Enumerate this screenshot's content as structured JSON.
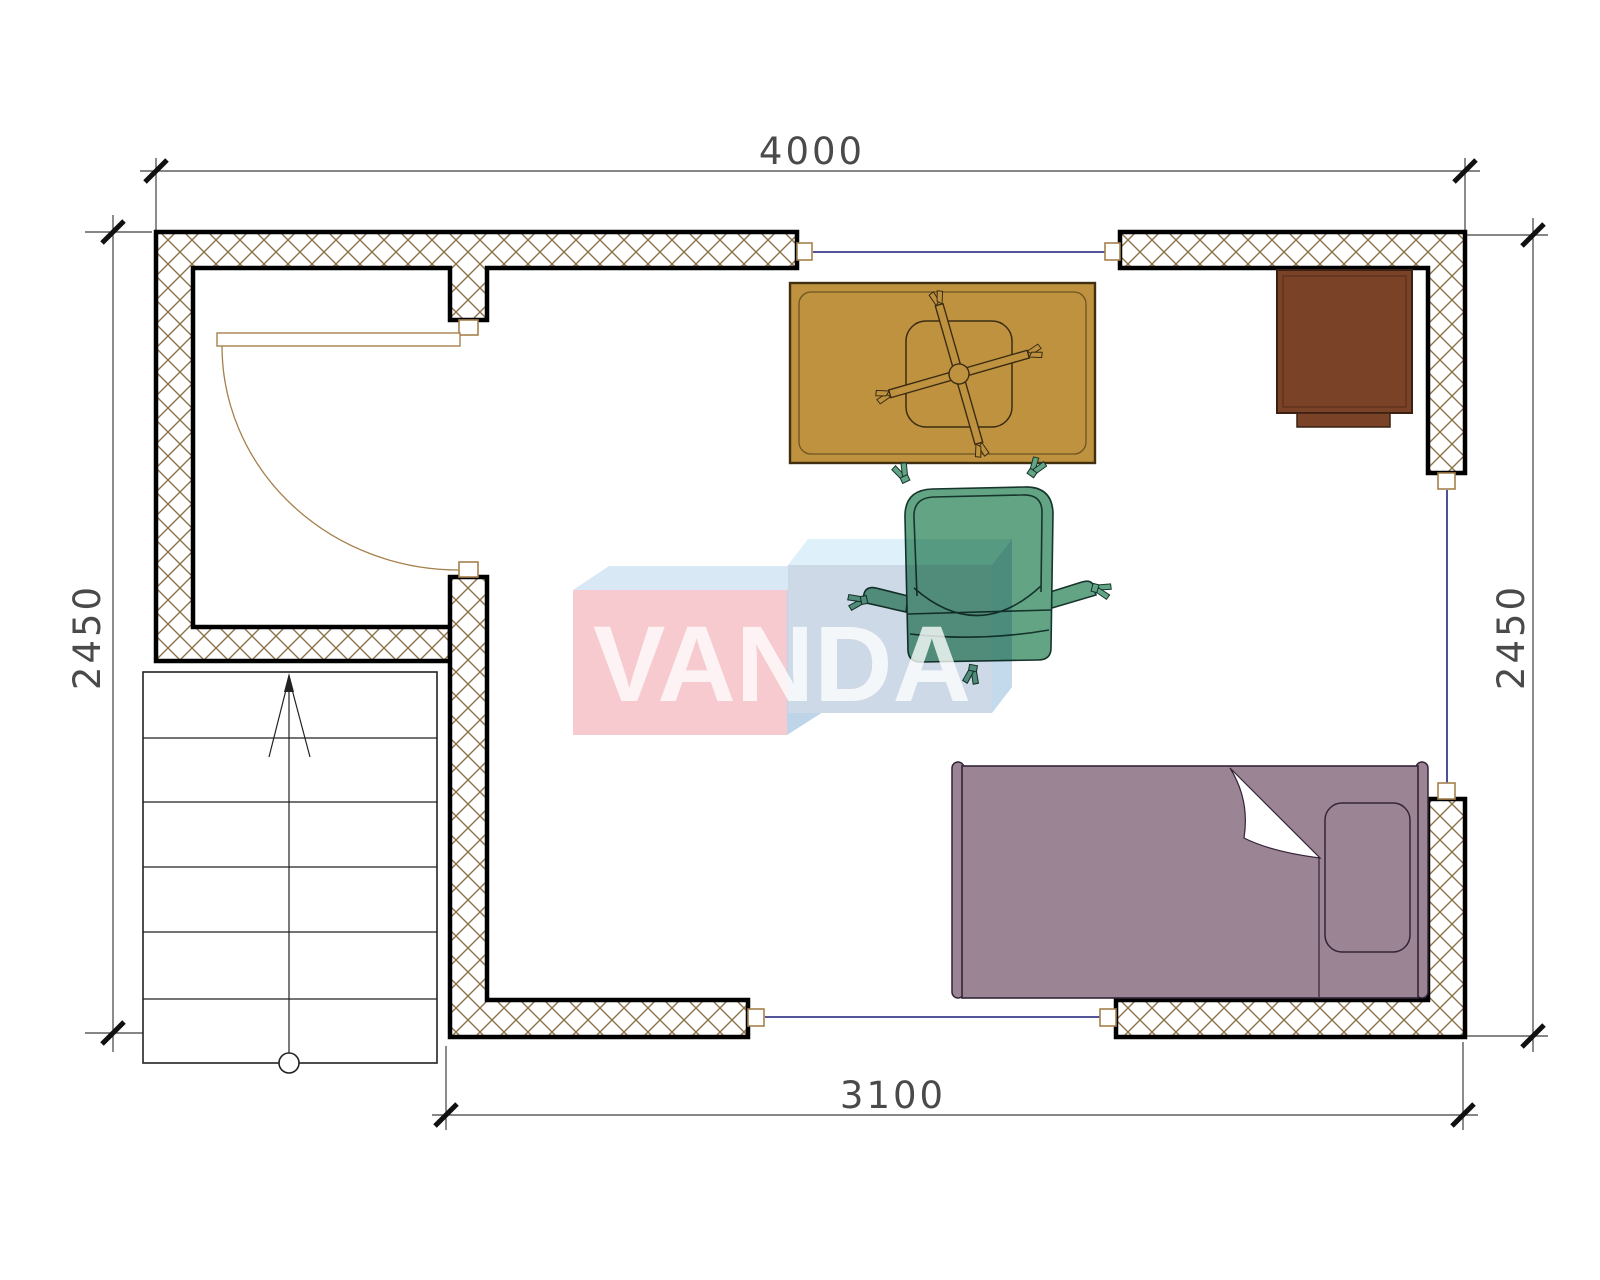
{
  "drawing": {
    "type": "architectural floor plan, top view, single room with stairs",
    "dimensions": {
      "top": "4000",
      "left": "2450",
      "right": "2450",
      "bottom": "3100"
    },
    "watermark": {
      "text": "VANDA"
    },
    "elements": [
      "walls-hatched",
      "door-swing",
      "windows",
      "stairs-with-direction-arrow",
      "desk",
      "desk-chair-x-base",
      "office-chair",
      "cabinet",
      "single-bed-with-pillow"
    ],
    "colors": {
      "wall_hatch_line": "#8d7149",
      "wall_outline": "#000000",
      "window_glass_line": "#3c3c8c",
      "frame_outline": "#a5804d",
      "desk": "#bf9240",
      "desk_outline": "#40300f",
      "desk_edge_line": "#6e5420",
      "chair": "#63a485",
      "chair_outline": "#16352c",
      "cabinet": "#7a4227",
      "cabinet_outline": "#3a2113",
      "bed": "#9b8595",
      "bed_outline": "#342438",
      "stairs_line": "#222222",
      "dimension_line": "#3f3f3f",
      "dimension_text": "#4a4a4a",
      "watermark_pink_front": "#f6cacf",
      "watermark_pink_top": "#d8e8f5",
      "watermark_blue_front": "#cdd9e7",
      "watermark_blue_top": "#def0fa",
      "watermark_blue_side": "#c3daed",
      "watermark_text": "#ffffff"
    }
  }
}
